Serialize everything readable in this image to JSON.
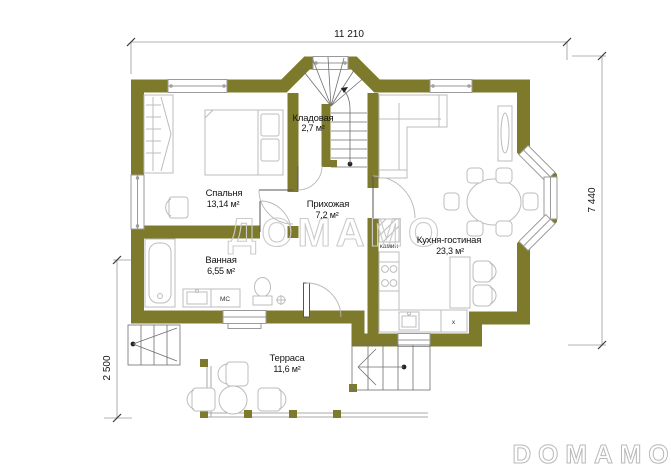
{
  "plan": {
    "dimensions": {
      "top": "11 210",
      "right": "7 440",
      "left": "2 500"
    },
    "rooms": [
      {
        "name": "Спальня",
        "area": "13,14 м²"
      },
      {
        "name": "Кладовая",
        "area": "2,7 м²"
      },
      {
        "name": "Прихожая",
        "area": "7,2 м²"
      },
      {
        "name": "Ванная",
        "area": "6,55 м²"
      },
      {
        "name": "Кухня-гостиная",
        "area": "23,3 м²"
      },
      {
        "name": "Терраса",
        "area": "11,6 м²"
      }
    ],
    "annotations": {
      "fireplace": "камин",
      "washer": "MC",
      "cabinet_x": "x"
    },
    "watermark": "ДОМАМО",
    "logo": "DOMAMO",
    "colors": {
      "wall": "#7d7b2b",
      "furniture": "#bcbcbc",
      "text": "#141414",
      "watermark": "#cbcbcb",
      "dimension": "#9a9a9a"
    }
  }
}
